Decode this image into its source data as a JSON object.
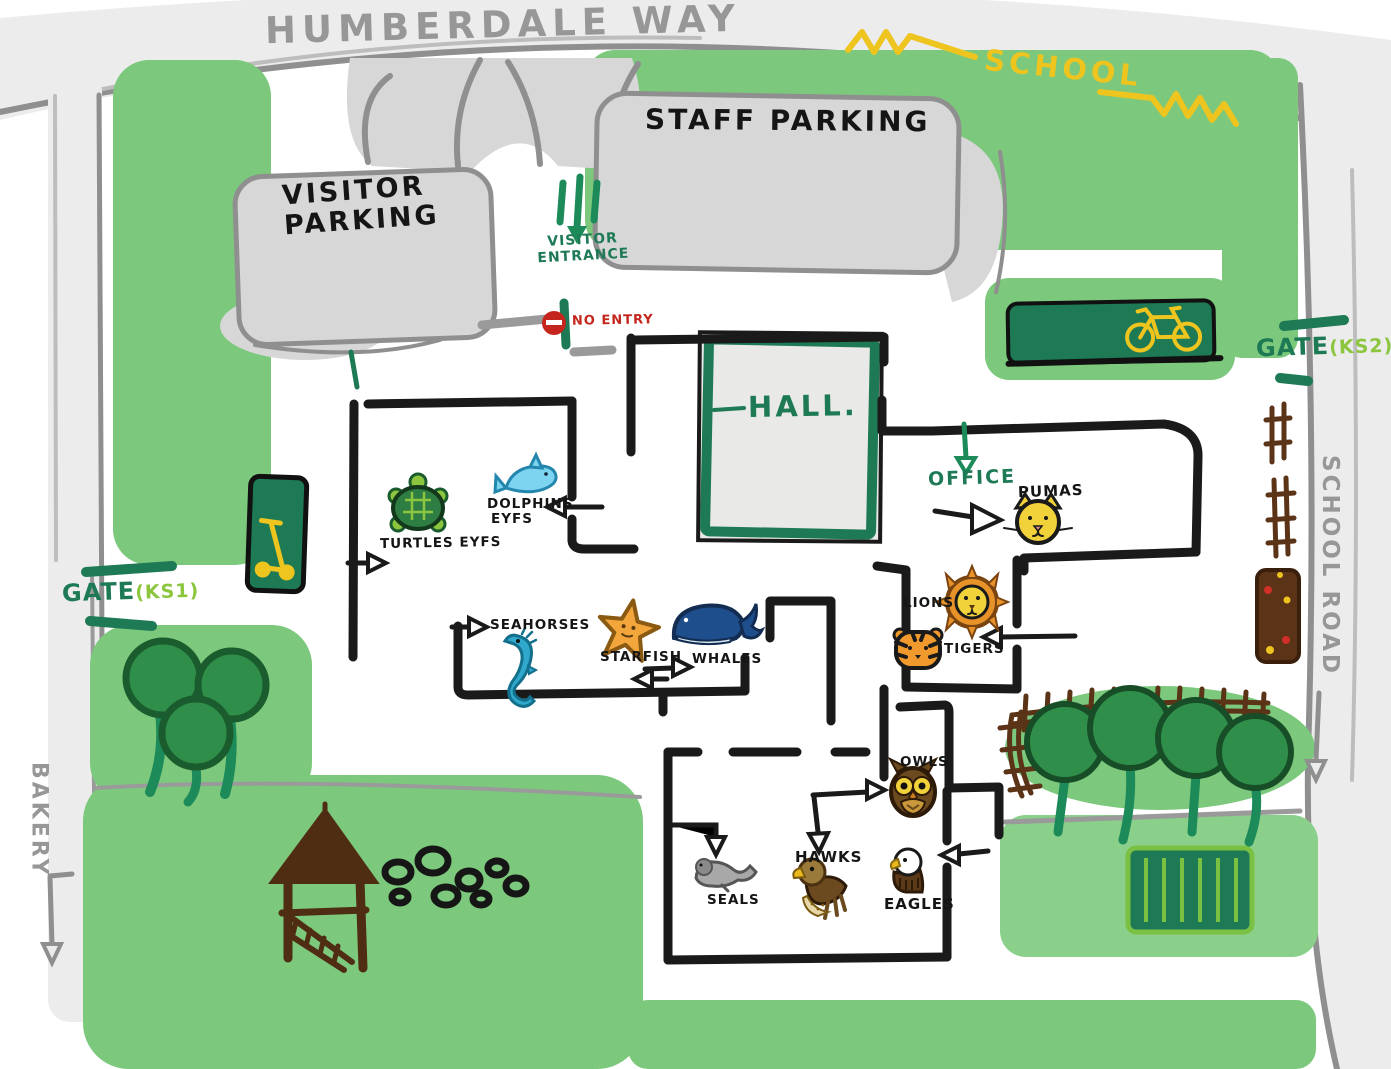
{
  "roads": {
    "humberdale_way": "HUMBERDALE WAY",
    "school_road": "SCHOOL ROAD",
    "bakery": "BAKERY"
  },
  "signs": {
    "school": "SCHOOL",
    "no_entry": "NO ENTRY",
    "visitor_entrance_line1": "VISITOR",
    "visitor_entrance_line2": "ENTRANCE",
    "gate_ks1_label": "GATE",
    "gate_ks1_suffix": "(KS1)",
    "gate_ks2_label": "GATE",
    "gate_ks2_suffix": "(KS2)"
  },
  "parking": {
    "visitor_line1": "VISITOR",
    "visitor_line2": "PARKING",
    "staff": "STAFF PARKING"
  },
  "buildings": {
    "hall": "HALL.",
    "office": "OFFICE"
  },
  "classrooms": [
    {
      "id": "turtles",
      "label": "TURTLES EYFS",
      "icon": "turtle-icon"
    },
    {
      "id": "dolphins",
      "label": "DOLPHINS",
      "label2": "EYFS",
      "icon": "dolphin-icon"
    },
    {
      "id": "seahorses",
      "label": "SEAHORSES",
      "icon": "seahorse-icon"
    },
    {
      "id": "starfish",
      "label": "STARFISH",
      "icon": "starfish-icon"
    },
    {
      "id": "whales",
      "label": "WHALES",
      "icon": "whale-icon"
    },
    {
      "id": "pumas",
      "label": "PUMAS",
      "icon": "puma-icon"
    },
    {
      "id": "lions",
      "label": "LIONS",
      "icon": "lion-icon"
    },
    {
      "id": "tigers",
      "label": "TIGERS",
      "icon": "tiger-icon"
    },
    {
      "id": "owls",
      "label": "OWLS",
      "icon": "owl-icon"
    },
    {
      "id": "hawks",
      "label": "HAWKS",
      "icon": "hawk-icon"
    },
    {
      "id": "seals",
      "label": "SEALS",
      "icon": "seal-icon"
    },
    {
      "id": "eagles",
      "label": "EAGLES",
      "icon": "eagle-icon"
    }
  ],
  "facilities": {
    "bike_shelter": "bicycle-icon",
    "scooter_shelter": "scooter-icon",
    "no_entry_sign": "no-entry-icon",
    "playground_tower": "climbing-tower",
    "tyre_trail": "tyres",
    "picnic_bench": "bench",
    "trees": "trees",
    "fence": "fence",
    "planter": "flower-planter"
  },
  "colors": {
    "grass": "#7cc87c",
    "grass_light": "#8ad08a",
    "road_fill": "#ececec",
    "road_edge": "#8f8f8f",
    "parking_fill": "#d7d7d7",
    "wall_black": "#1a1a1a",
    "green_dark": "#1d7a55",
    "green_light": "#8cc63e",
    "sign_yellow": "#eec41e",
    "no_entry_red": "#c4261d",
    "wood_brown": "#5b3317",
    "text_gray": "#979797"
  }
}
